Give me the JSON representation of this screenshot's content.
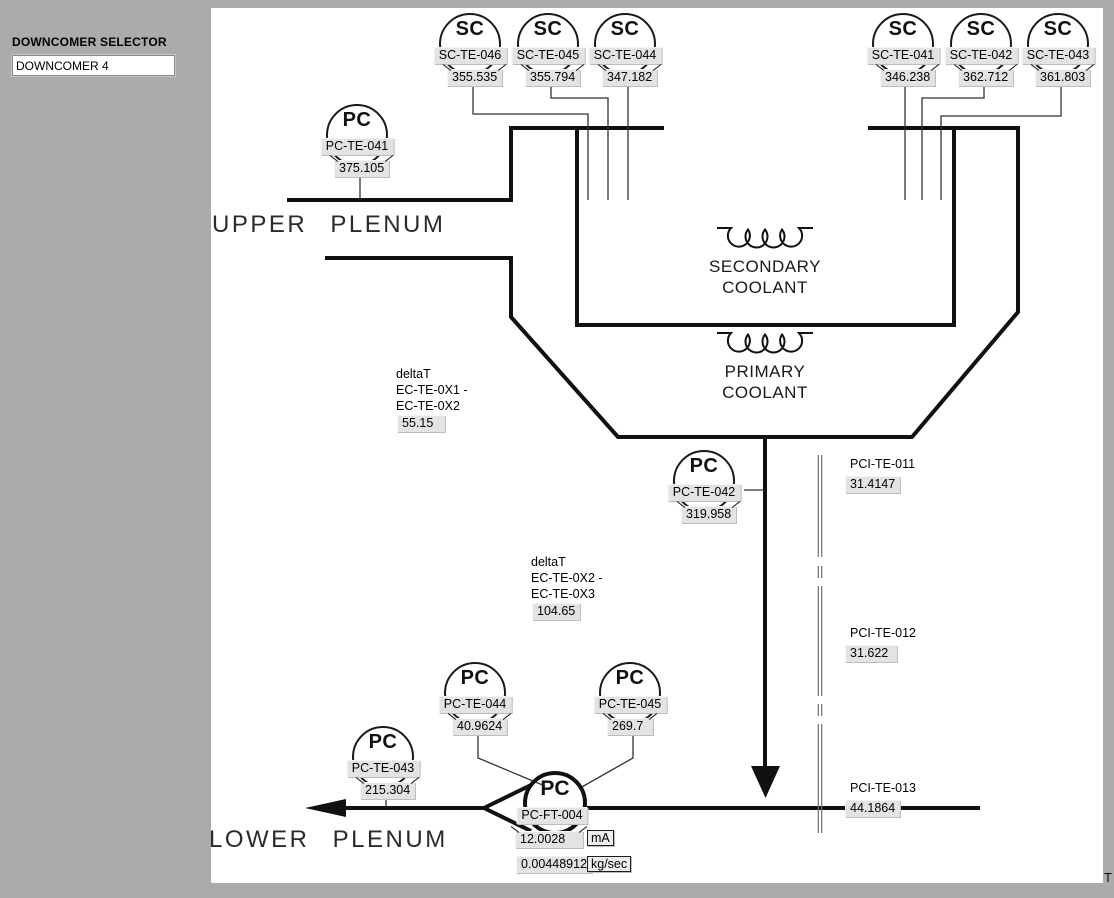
{
  "window": {
    "corner_text": "T",
    "background_color": "#ababab",
    "canvas_color": "#ffffff"
  },
  "sidebar": {
    "selector_label": "DOWNCOMER SELECTOR",
    "selector_value": "DOWNCOMER 4"
  },
  "regions": {
    "upper_plenum": "UPPER PLENUM",
    "lower_plenum": "LOWER PLENUM",
    "secondary_line1": "SECONDARY",
    "secondary_line2": "COOLANT",
    "primary_line1": "PRIMARY",
    "primary_line2": "COOLANT"
  },
  "instruments": [
    {
      "letter": "SC",
      "tag": "SC-TE-046",
      "value": "355.535"
    },
    {
      "letter": "SC",
      "tag": "SC-TE-045",
      "value": "355.794"
    },
    {
      "letter": "SC",
      "tag": "SC-TE-044",
      "value": "347.182"
    },
    {
      "letter": "SC",
      "tag": "SC-TE-041",
      "value": "346.238"
    },
    {
      "letter": "SC",
      "tag": "SC-TE-042",
      "value": "362.712"
    },
    {
      "letter": "SC",
      "tag": "SC-TE-043",
      "value": "361.803"
    },
    {
      "letter": "PC",
      "tag": "PC-TE-041",
      "value": "375.105"
    },
    {
      "letter": "PC",
      "tag": "PC-TE-042",
      "value": "319.958"
    },
    {
      "letter": "PC",
      "tag": "PC-TE-044",
      "value": "40.9624"
    },
    {
      "letter": "PC",
      "tag": "PC-TE-045",
      "value": "269.7"
    },
    {
      "letter": "PC",
      "tag": "PC-TE-043",
      "value": "215.304"
    }
  ],
  "delta_t": [
    {
      "line1": "deltaT",
      "line2": "EC-TE-0X1 -",
      "line3": "EC-TE-0X2",
      "value": "55.15"
    },
    {
      "line1": "deltaT",
      "line2": "EC-TE-0X2 -",
      "line3": "EC-TE-0X3",
      "value": "104.65"
    }
  ],
  "pci_sensors": [
    {
      "tag": "PCI-TE-011",
      "value": "31.4147"
    },
    {
      "tag": "PCI-TE-012",
      "value": "31.622"
    },
    {
      "tag": "PCI-TE-013",
      "value": "44.1864"
    }
  ],
  "flow_transmitter": {
    "letter": "PC",
    "tag": "PC-FT-004",
    "current": "12.0028",
    "current_unit": "mA",
    "flow": "0.00448912",
    "flow_unit": "kg/sec"
  }
}
